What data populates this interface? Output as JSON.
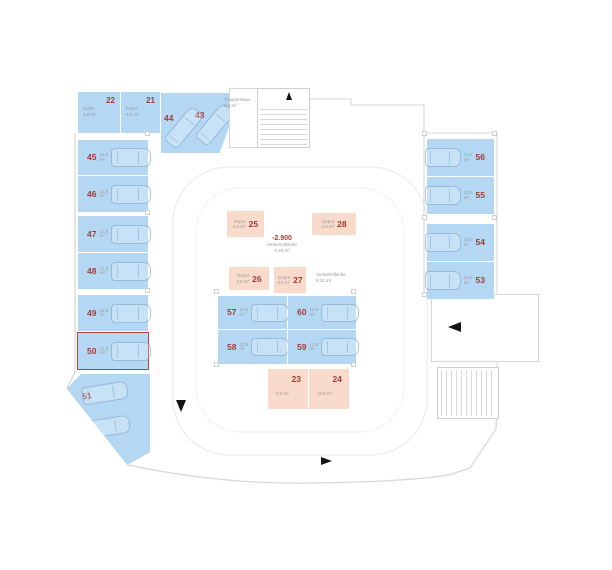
{
  "colors": {
    "available": "#b4d8f3",
    "depot": "#f8dbcb",
    "number": "#a03d35",
    "selected": "#c13b3b",
    "wall": "#d6d6d6",
    "lane": "#ececec",
    "muted": "#9b9b9b",
    "arrow": "#151515"
  },
  "level": {
    "elevation": "-2.900",
    "area_label": "Verkehrsfläche",
    "area_value": "5.28 m²"
  },
  "traffic_area": {
    "label": "Verkehrsfläche",
    "value": "8.31 m²"
  },
  "stairwell": {
    "label": "Treppenhaus",
    "value": "6.0 m²"
  },
  "spaces": {
    "s21": {
      "number": "21",
      "label": "Keller",
      "area": "5.6 m²"
    },
    "s22": {
      "number": "22",
      "label": "Keller",
      "area": "5.8 m²"
    },
    "s23": {
      "number": "23",
      "area": "8.0 m²"
    },
    "s24": {
      "number": "24",
      "area": "10.5 m²"
    },
    "s25": {
      "number": "25",
      "label": "Depot",
      "area": "4.0 m²"
    },
    "s26": {
      "number": "26",
      "label": "Depot",
      "area": "3.9 m²"
    },
    "s27": {
      "number": "27",
      "label": "Depot",
      "area": "3.6 m²"
    },
    "s28": {
      "number": "28",
      "label": "Depot",
      "area": "3.5 m²"
    },
    "s43": {
      "number": "43",
      "area": "12.5 m²"
    },
    "s44": {
      "number": "44",
      "area": "12.5 m²"
    },
    "s45": {
      "number": "45",
      "area": "12.5 m²"
    },
    "s46": {
      "number": "46",
      "area": "12.5 m²"
    },
    "s47": {
      "number": "47",
      "area": "12.5 m²"
    },
    "s48": {
      "number": "48",
      "area": "12.5 m²"
    },
    "s49": {
      "number": "49",
      "area": "12.5 m²"
    },
    "s50": {
      "number": "50",
      "area": "12.5 m²",
      "selected": true
    },
    "s51": {
      "number": "51",
      "area": "12.5 m²"
    },
    "s52": {
      "number": "52",
      "area": "12.5 m²"
    },
    "s53": {
      "number": "53",
      "area": "12.5 m²"
    },
    "s54": {
      "number": "54",
      "area": "12.5 m²"
    },
    "s55": {
      "number": "55",
      "area": "12.5 m²"
    },
    "s56": {
      "number": "56",
      "area": "12.5 m²"
    },
    "s57": {
      "number": "57",
      "area": "12.5 m²"
    },
    "s58": {
      "number": "58",
      "area": "12.5 m²"
    },
    "s59": {
      "number": "59",
      "area": "12.5 m²"
    },
    "s60": {
      "number": "60",
      "area": "12.5 m²"
    }
  }
}
